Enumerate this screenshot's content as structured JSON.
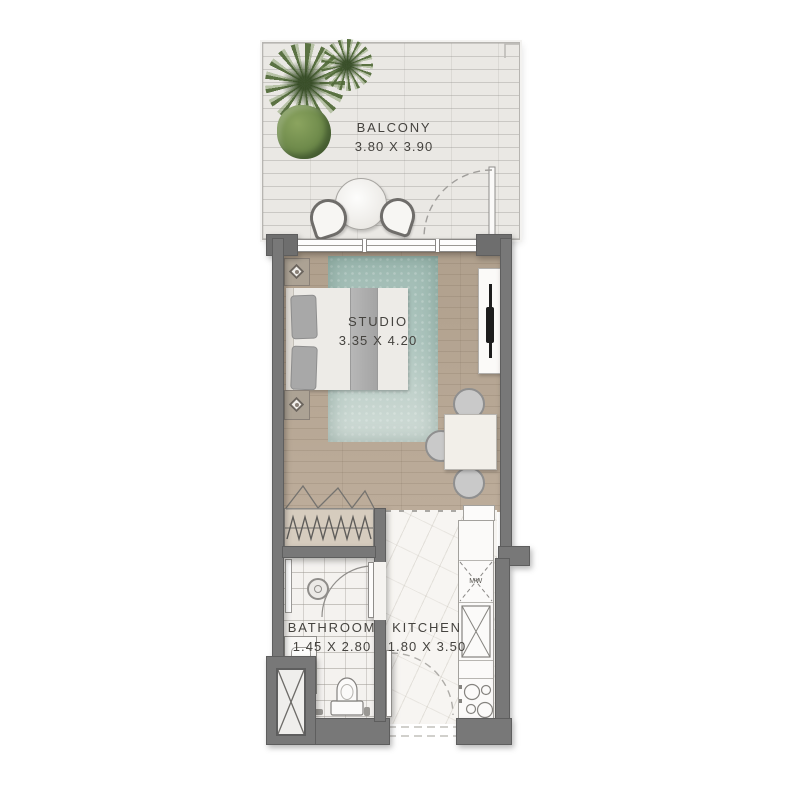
{
  "rooms": {
    "balcony": {
      "label": "BALCONY",
      "dimensions": "3.80 X 3.90"
    },
    "studio": {
      "label": "STUDIO",
      "dimensions": "3.35 X 4.20"
    },
    "bathroom": {
      "label": "BATHROOM",
      "dimensions": "1.45 X 2.80"
    },
    "kitchen": {
      "label": "KITCHEN",
      "dimensions": "1.80 X 3.50"
    }
  },
  "labels": {
    "microwave": "MW"
  },
  "colors": {
    "wall": "#787878",
    "wood_floor": "#b5a492",
    "balcony_floor": "#eae8e4",
    "marble_floor": "#f7f5f2",
    "bathroom_tile": "#f4f2ef",
    "rug": "#a9c3bb",
    "plant": "#5f7d49",
    "background": "#ffffff"
  }
}
